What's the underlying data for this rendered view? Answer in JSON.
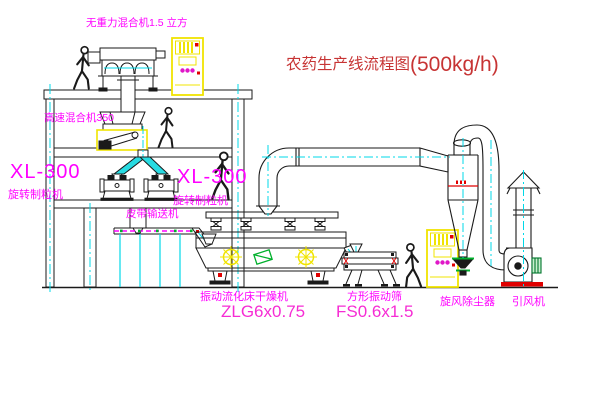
{
  "title": {
    "name": "农药生产线流程图",
    "capacity": "(500kg/h)"
  },
  "equipment_labels": {
    "gravity_mixer": "无重力混合机1.5 立方",
    "high_speed_mixer": "高速混合机350",
    "granulator_left": {
      "model": "XL-300",
      "name": "旋转制粒机"
    },
    "granulator_center": {
      "model": "XL-300",
      "name": "旋转制粒机"
    },
    "belt_conveyor": "皮带输送机",
    "fluid_bed_dryer": {
      "name": "振动流化床干燥机",
      "model": "ZLG6x0.75"
    },
    "vibrating_sieve": {
      "name": "方形振动筛",
      "model": "FS0.6x1.5"
    },
    "cyclone": "旋风除尘器",
    "induced_draft_fan": "引风机"
  },
  "colors": {
    "label_magenta": "#ff00ff",
    "model_pink": "#f62cd4",
    "title_red": "#c73434",
    "accent_red": "#e00000",
    "cabinet_yellow": "#f0e400",
    "centerline_cyan": "#00d9e8",
    "valve_green": "#00b02c",
    "line_black": "#1a1a1a"
  }
}
